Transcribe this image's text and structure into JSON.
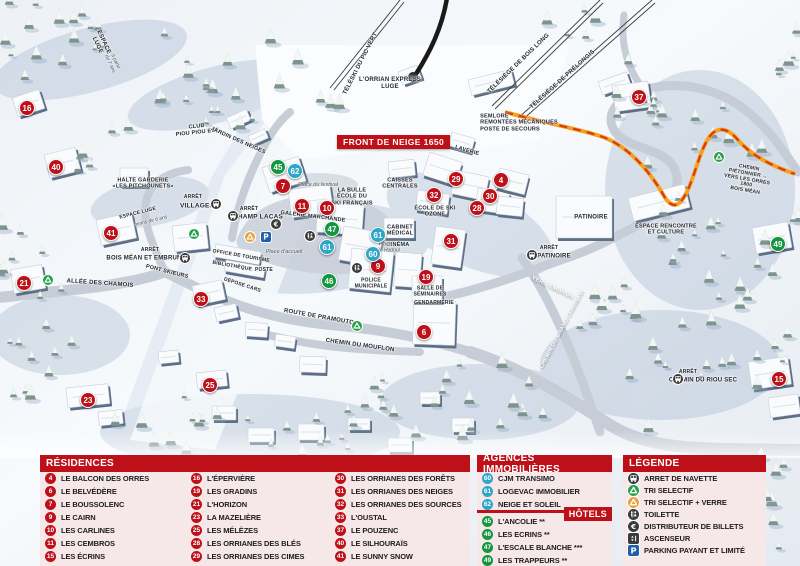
{
  "map": {
    "banner": "FRONT DE NEIGE 1650",
    "markers": [
      {
        "num": "16",
        "type": "residence",
        "x": 27,
        "y": 108
      },
      {
        "num": "40",
        "type": "residence",
        "x": 56,
        "y": 167
      },
      {
        "num": "41",
        "type": "residence",
        "x": 111,
        "y": 233
      },
      {
        "num": "21",
        "type": "residence",
        "x": 24,
        "y": 283
      },
      {
        "num": "23",
        "type": "residence",
        "x": 88,
        "y": 400
      },
      {
        "num": "25",
        "type": "residence",
        "x": 210,
        "y": 385
      },
      {
        "num": "33",
        "type": "residence",
        "x": 201,
        "y": 299
      },
      {
        "num": "7",
        "type": "residence",
        "x": 283,
        "y": 186
      },
      {
        "num": "11",
        "type": "residence",
        "x": 302,
        "y": 206
      },
      {
        "num": "10",
        "type": "residence",
        "x": 327,
        "y": 208
      },
      {
        "num": "9",
        "type": "residence",
        "x": 378,
        "y": 266
      },
      {
        "num": "19",
        "type": "residence",
        "x": 426,
        "y": 277
      },
      {
        "num": "6",
        "type": "residence",
        "x": 424,
        "y": 332
      },
      {
        "num": "29",
        "type": "residence",
        "x": 456,
        "y": 179
      },
      {
        "num": "32",
        "type": "residence",
        "x": 434,
        "y": 195
      },
      {
        "num": "30",
        "type": "residence",
        "x": 490,
        "y": 196
      },
      {
        "num": "28",
        "type": "residence",
        "x": 477,
        "y": 208
      },
      {
        "num": "4",
        "type": "residence",
        "x": 501,
        "y": 180
      },
      {
        "num": "31",
        "type": "residence",
        "x": 451,
        "y": 241
      },
      {
        "num": "37",
        "type": "residence",
        "x": 639,
        "y": 97
      },
      {
        "num": "15",
        "type": "residence",
        "x": 779,
        "y": 379
      },
      {
        "num": "62",
        "type": "agence",
        "x": 295,
        "y": 171
      },
      {
        "num": "61",
        "type": "agence",
        "x": 327,
        "y": 247
      },
      {
        "num": "61",
        "type": "agence",
        "x": 378,
        "y": 235
      },
      {
        "num": "60",
        "type": "agence",
        "x": 373,
        "y": 254
      },
      {
        "num": "45",
        "type": "hotel",
        "x": 278,
        "y": 167
      },
      {
        "num": "47",
        "type": "hotel",
        "x": 332,
        "y": 229
      },
      {
        "num": "46",
        "type": "hotel",
        "x": 329,
        "y": 281
      },
      {
        "num": "49",
        "type": "hotel",
        "x": 778,
        "y": 244
      }
    ],
    "labels": [
      {
        "t": "ESPACE\nLUGE",
        "x": 100,
        "y": 44,
        "r": 65,
        "s": 6
      },
      {
        "t": "à partir\nde 7 ans",
        "x": 112,
        "y": 63,
        "r": 65,
        "s": 5,
        "i": 1
      },
      {
        "t": "TÉLÉSKI DU PIC VERT",
        "x": 361,
        "y": 64,
        "r": -63,
        "s": 6
      },
      {
        "t": "L'ORRIAN EXPRESS\nLUGE",
        "x": 390,
        "y": 84,
        "s": 6
      },
      {
        "t": "TÉLÉSIÈGE DE BOIS LONG",
        "x": 519,
        "y": 64,
        "r": -44,
        "s": 6
      },
      {
        "t": "TÉLÉSIÈGE DE PRÉLONGIS",
        "x": 563,
        "y": 80,
        "r": -42,
        "s": 6
      },
      {
        "t": "SEMLORE\nREMONTÉES MÉCANIQUES\nPOSTE DE SECOURS",
        "x": 519,
        "y": 123,
        "s": 5.5,
        "a": 1
      },
      {
        "t": "CLUB\nPIOU PIOU ESF",
        "x": 197,
        "y": 130,
        "r": -6,
        "s": 5.5
      },
      {
        "t": "JARDIN DES NEIGES",
        "x": 238,
        "y": 141,
        "r": 24,
        "s": 5.5
      },
      {
        "t": "HALTE GARDERIE\n«LES PITCHOUNETS»",
        "x": 143,
        "y": 184,
        "s": 5.5
      },
      {
        "t": "ARRÊT",
        "x": 193,
        "y": 198,
        "s": 5
      },
      {
        "t": "VILLAGES",
        "x": 197,
        "y": 206,
        "s": 6.5
      },
      {
        "t": "ARRÊT",
        "x": 249,
        "y": 210,
        "s": 5
      },
      {
        "t": "CHAMP LACAS",
        "x": 258,
        "y": 217,
        "s": 6.5
      },
      {
        "t": "ARRÊT",
        "x": 150,
        "y": 251,
        "s": 5
      },
      {
        "t": "BOIS MÉAN ET EMBRUN",
        "x": 144,
        "y": 259,
        "s": 6
      },
      {
        "t": "LA BULLE\nÉCOLE DU\nSKI FRANÇAIS",
        "x": 352,
        "y": 197,
        "s": 5.5
      },
      {
        "t": "GALERIE MARCHANDE",
        "x": 313,
        "y": 217,
        "r": 7,
        "s": 5.5
      },
      {
        "t": "CAISSES\nCENTRALES",
        "x": 400,
        "y": 184,
        "s": 5.5
      },
      {
        "t": "CABINET\nMÉDICAL",
        "x": 400,
        "y": 231,
        "s": 5.5
      },
      {
        "t": "CINÉMA",
        "x": 398,
        "y": 245,
        "s": 5.5
      },
      {
        "t": "ÉCOLE DE SKI\nOZONE",
        "x": 435,
        "y": 212,
        "s": 5.5
      },
      {
        "t": "LAVERIE",
        "x": 467,
        "y": 151,
        "r": 16,
        "s": 5.5
      },
      {
        "t": "PATINOIRE",
        "x": 591,
        "y": 218,
        "s": 6
      },
      {
        "t": "ESPACE RENCONTRE\nET CULTURE",
        "x": 666,
        "y": 230,
        "s": 5.5
      },
      {
        "t": "OFFICE DE TOURISME",
        "x": 241,
        "y": 257,
        "r": 10,
        "s": 5
      },
      {
        "t": "BIBLIOTHÈQUE",
        "x": 232,
        "y": 267,
        "r": 10,
        "s": 5
      },
      {
        "t": "POSTE",
        "x": 264,
        "y": 271,
        "s": 5
      },
      {
        "t": "DÉPOSE CARS",
        "x": 242,
        "y": 286,
        "r": 18,
        "s": 5
      },
      {
        "t": "POLICE\nMUNICIPALE",
        "x": 371,
        "y": 284,
        "s": 5
      },
      {
        "t": "SALLE DE\nSÉMINAIRES",
        "x": 430,
        "y": 292,
        "s": 5
      },
      {
        "t": "GENDARMERIE",
        "x": 434,
        "y": 304,
        "s": 5
      },
      {
        "t": "Place du festival",
        "x": 318,
        "y": 185,
        "s": 5.5,
        "i": 1
      },
      {
        "t": "Place d'accueil",
        "x": 284,
        "y": 252,
        "s": 5.5,
        "i": 1
      },
      {
        "t": "Place\nÉmile Hodoul",
        "x": 385,
        "y": 248,
        "s": 5,
        "i": 1
      },
      {
        "t": "ALLÉE DES CHAMOIS",
        "x": 100,
        "y": 284,
        "r": 4,
        "s": 6
      },
      {
        "t": "PONT SKIEURS",
        "x": 167,
        "y": 272,
        "r": 14,
        "s": 5.5
      },
      {
        "t": "ROUTE DE PRAMOUTON",
        "x": 321,
        "y": 318,
        "r": 10,
        "s": 6
      },
      {
        "t": "CHEMIN DU MOUFLON",
        "x": 360,
        "y": 346,
        "r": 8,
        "s": 6
      },
      {
        "t": "CHEMIN DU GRAND CORBEAU",
        "x": 562,
        "y": 330,
        "r": -62,
        "s": 5.5,
        "c": "#ffffff"
      },
      {
        "t": "VERS EMBRUN →",
        "x": 556,
        "y": 290,
        "r": 26,
        "s": 6,
        "c": "#ffffff"
      },
      {
        "t": "CHEMIN PIÉTONNIER →\nVERS LES ORRES 1800\nBOIS MÉAN",
        "x": 747,
        "y": 180,
        "r": 10,
        "s": 5
      },
      {
        "t": "ARRÊT",
        "x": 688,
        "y": 373,
        "s": 5
      },
      {
        "t": "CHEMIN DU RIOU SEC",
        "x": 703,
        "y": 381,
        "s": 6
      },
      {
        "t": "ARRÊT",
        "x": 549,
        "y": 249,
        "s": 5
      },
      {
        "t": "PATINOIRE",
        "x": 554,
        "y": 257,
        "s": 6
      },
      {
        "t": "ESPACE LUGE",
        "x": 138,
        "y": 214,
        "r": -14,
        "s": 5
      },
      {
        "t": "moins de 6 ans",
        "x": 151,
        "y": 222,
        "r": -14,
        "s": 5,
        "i": 1
      }
    ],
    "icons": [
      {
        "k": "bus",
        "x": 216,
        "y": 204
      },
      {
        "k": "bus",
        "x": 233,
        "y": 216
      },
      {
        "k": "bus",
        "x": 185,
        "y": 258
      },
      {
        "k": "bus",
        "x": 532,
        "y": 255
      },
      {
        "k": "bus",
        "x": 678,
        "y": 379
      },
      {
        "k": "recycle-green",
        "x": 48,
        "y": 280
      },
      {
        "k": "recycle-green",
        "x": 194,
        "y": 234
      },
      {
        "k": "recycle-green",
        "x": 357,
        "y": 326
      },
      {
        "k": "recycle-green",
        "x": 719,
        "y": 157
      },
      {
        "k": "recycle-yellow",
        "x": 250,
        "y": 237
      },
      {
        "k": "euro",
        "x": 276,
        "y": 224
      },
      {
        "k": "toilet",
        "x": 310,
        "y": 236
      },
      {
        "k": "toilet",
        "x": 357,
        "y": 268
      },
      {
        "k": "parking",
        "x": 266,
        "y": 237
      }
    ]
  },
  "legend": {
    "residences": {
      "title": "RÉSIDENCES",
      "items": [
        {
          "num": "4",
          "label": "LE BALCON DES ORRES"
        },
        {
          "num": "6",
          "label": "LE BELVÉDÈRE"
        },
        {
          "num": "7",
          "label": "LE BOUSSOLENC"
        },
        {
          "num": "9",
          "label": "LE CAIRN"
        },
        {
          "num": "10",
          "label": "LES CARLINES"
        },
        {
          "num": "11",
          "label": "LES CEMBROS"
        },
        {
          "num": "15",
          "label": "LES ÉCRINS"
        },
        {
          "num": "16",
          "label": "L'ÉPERVIÈRE"
        },
        {
          "num": "19",
          "label": "LES GRADINS"
        },
        {
          "num": "21",
          "label": "L'HORIZON"
        },
        {
          "num": "23",
          "label": "LA MAZELIÈRE"
        },
        {
          "num": "25",
          "label": "LES MÉLÈZES"
        },
        {
          "num": "28",
          "label": "LES ORRIANES DES BLÉS"
        },
        {
          "num": "29",
          "label": "LES ORRIANES DES CIMES"
        },
        {
          "num": "30",
          "label": "LES ORRIANES DES FORÊTS"
        },
        {
          "num": "31",
          "label": "LES ORRIANES DES NEIGES"
        },
        {
          "num": "32",
          "label": "LES ORRIANES DES SOURCES"
        },
        {
          "num": "33",
          "label": "L'OUSTAL"
        },
        {
          "num": "37",
          "label": "LE POUZENC"
        },
        {
          "num": "40",
          "label": "LE SILHOURAÏS"
        },
        {
          "num": "41",
          "label": "LE SUNNY SNOW"
        }
      ]
    },
    "agences": {
      "title": "AGENCES IMMOBILIÈRES",
      "items": [
        {
          "num": "60",
          "label": "CJM TRANSIMO"
        },
        {
          "num": "61",
          "label": "LOGEVAC IMMOBILIER"
        },
        {
          "num": "62",
          "label": "NEIGE ET SOLEIL"
        }
      ]
    },
    "hotels": {
      "title": "HÔTELS",
      "items": [
        {
          "num": "45",
          "label": "L'ANCOLIE **"
        },
        {
          "num": "46",
          "label": "LES ECRINS **"
        },
        {
          "num": "47",
          "label": "L'ESCALE BLANCHE ***"
        },
        {
          "num": "49",
          "label": "LES TRAPPEURS **"
        }
      ]
    },
    "legende": {
      "title": "LÉGENDE",
      "items": [
        {
          "icon": "bus",
          "label": "ARRET DE NAVETTE"
        },
        {
          "icon": "recycle-green",
          "label": "TRI SELECTIF"
        },
        {
          "icon": "recycle-yellow",
          "label": "TRI SELECTIF + VERRE"
        },
        {
          "icon": "toilet",
          "label": "TOILETTE"
        },
        {
          "icon": "euro",
          "label": "DISTRIBUTEUR DE BILLETS"
        },
        {
          "icon": "elevator",
          "label": "ASCENSEUR"
        },
        {
          "icon": "parking",
          "label": "PARKING PAYANT ET LIMITÉ"
        }
      ]
    }
  },
  "colors": {
    "header_red": "#BE1019",
    "marker_red": "#BE1019",
    "marker_blue": "#2EA6C8",
    "marker_green": "#12963F",
    "legend_bg": "#F6E8E8"
  }
}
